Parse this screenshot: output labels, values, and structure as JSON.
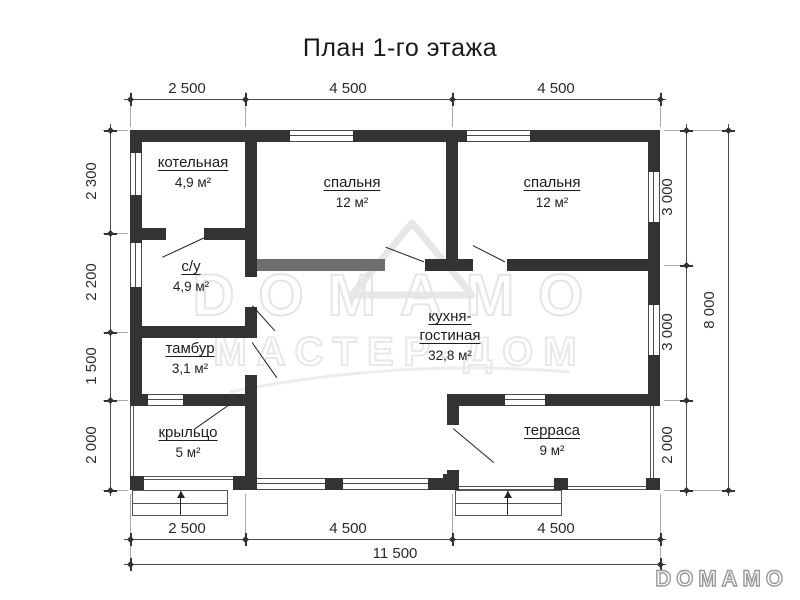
{
  "title": "План 1-го этажа",
  "rooms": [
    {
      "name": "котельная",
      "area": "4,9 м²"
    },
    {
      "name": "спальня",
      "area": "12 м²"
    },
    {
      "name": "спальня",
      "area": "12 м²"
    },
    {
      "name": "с/у",
      "area": "4,9 м²"
    },
    {
      "name": "тамбур",
      "area": "3,1 м²"
    },
    {
      "name": "кухня-гостиная",
      "area": "32,8 м²"
    },
    {
      "name": "крыльцо",
      "area": "5 м²"
    },
    {
      "name": "терраса",
      "area": "9 м²"
    }
  ],
  "dimensions": {
    "top": [
      "2 500",
      "4 500",
      "4 500"
    ],
    "left": [
      "2 300",
      "2 200",
      "1 500",
      "2 000"
    ],
    "right": [
      "3 000",
      "3 000",
      "2 000"
    ],
    "right_total": "8 000",
    "bottom": [
      "2 500",
      "4 500",
      "4 500"
    ],
    "bottom_total": "11 500"
  },
  "watermark": {
    "brand": "DOMAMO",
    "subtitle": "МАСТЕР-ДОМ",
    "corner_logo": "DOMAMO"
  },
  "colors": {
    "wall": "#333333",
    "wall_light": "#6f6f6f",
    "dimension": "#4a4a4a",
    "watermark": "#e5e5e5",
    "background": "#ffffff"
  }
}
